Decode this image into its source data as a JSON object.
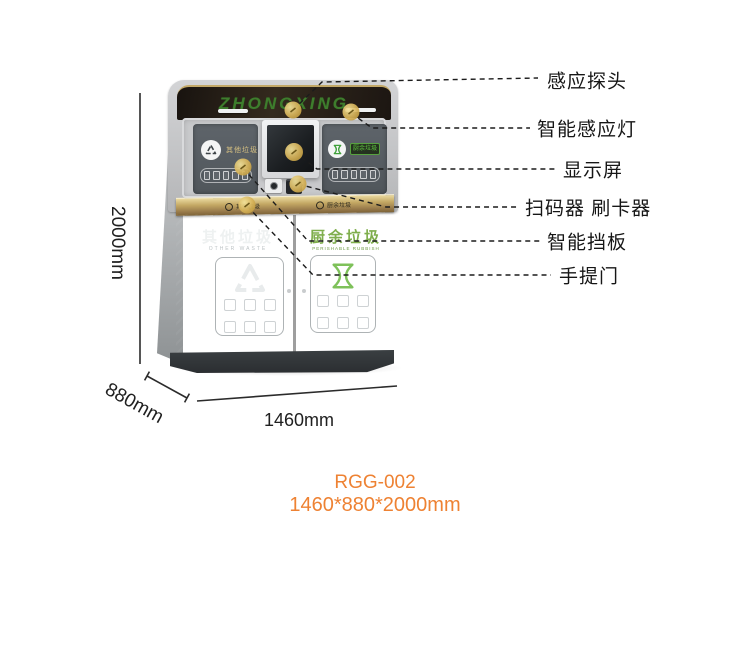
{
  "machine": {
    "brand": "ZHONGXING",
    "head": {
      "left_panel_label": "其他垃圾",
      "right_panel_label": "厨余垃圾"
    },
    "band": {
      "left_label": "其他垃圾",
      "right_label": "厨余垃圾"
    },
    "doors": {
      "left": {
        "title": "其他垃圾",
        "subtitle": "OTHER WASTE"
      },
      "right": {
        "title": "厨余垃圾",
        "subtitle": "PERISHABLE RUBBISH"
      }
    }
  },
  "annotations": {
    "callouts": [
      {
        "label": "感应探头",
        "target": "sensor-probe"
      },
      {
        "label": "智能感应灯",
        "target": "smart-sensor-light"
      },
      {
        "label": "显示屏",
        "target": "display-screen"
      },
      {
        "label": "扫码器 刷卡器",
        "target": "scanner-card-reader"
      },
      {
        "label": "智能挡板",
        "target": "smart-baffle"
      },
      {
        "label": "手提门",
        "target": "lift-door"
      }
    ],
    "dimensions": {
      "height": "2000mm",
      "depth": "880mm",
      "width": "1460mm"
    }
  },
  "footer": {
    "model": "RGG-002",
    "size": "1460*880*2000mm"
  },
  "colors": {
    "accent_orange": "#ee8233",
    "brand_green": "#3e7d2d",
    "kitchen_green": "#7fae4c",
    "gold_band": "#b99c5e",
    "callout_dot": "#d9b65c",
    "body_charcoal": "#4a5156"
  }
}
